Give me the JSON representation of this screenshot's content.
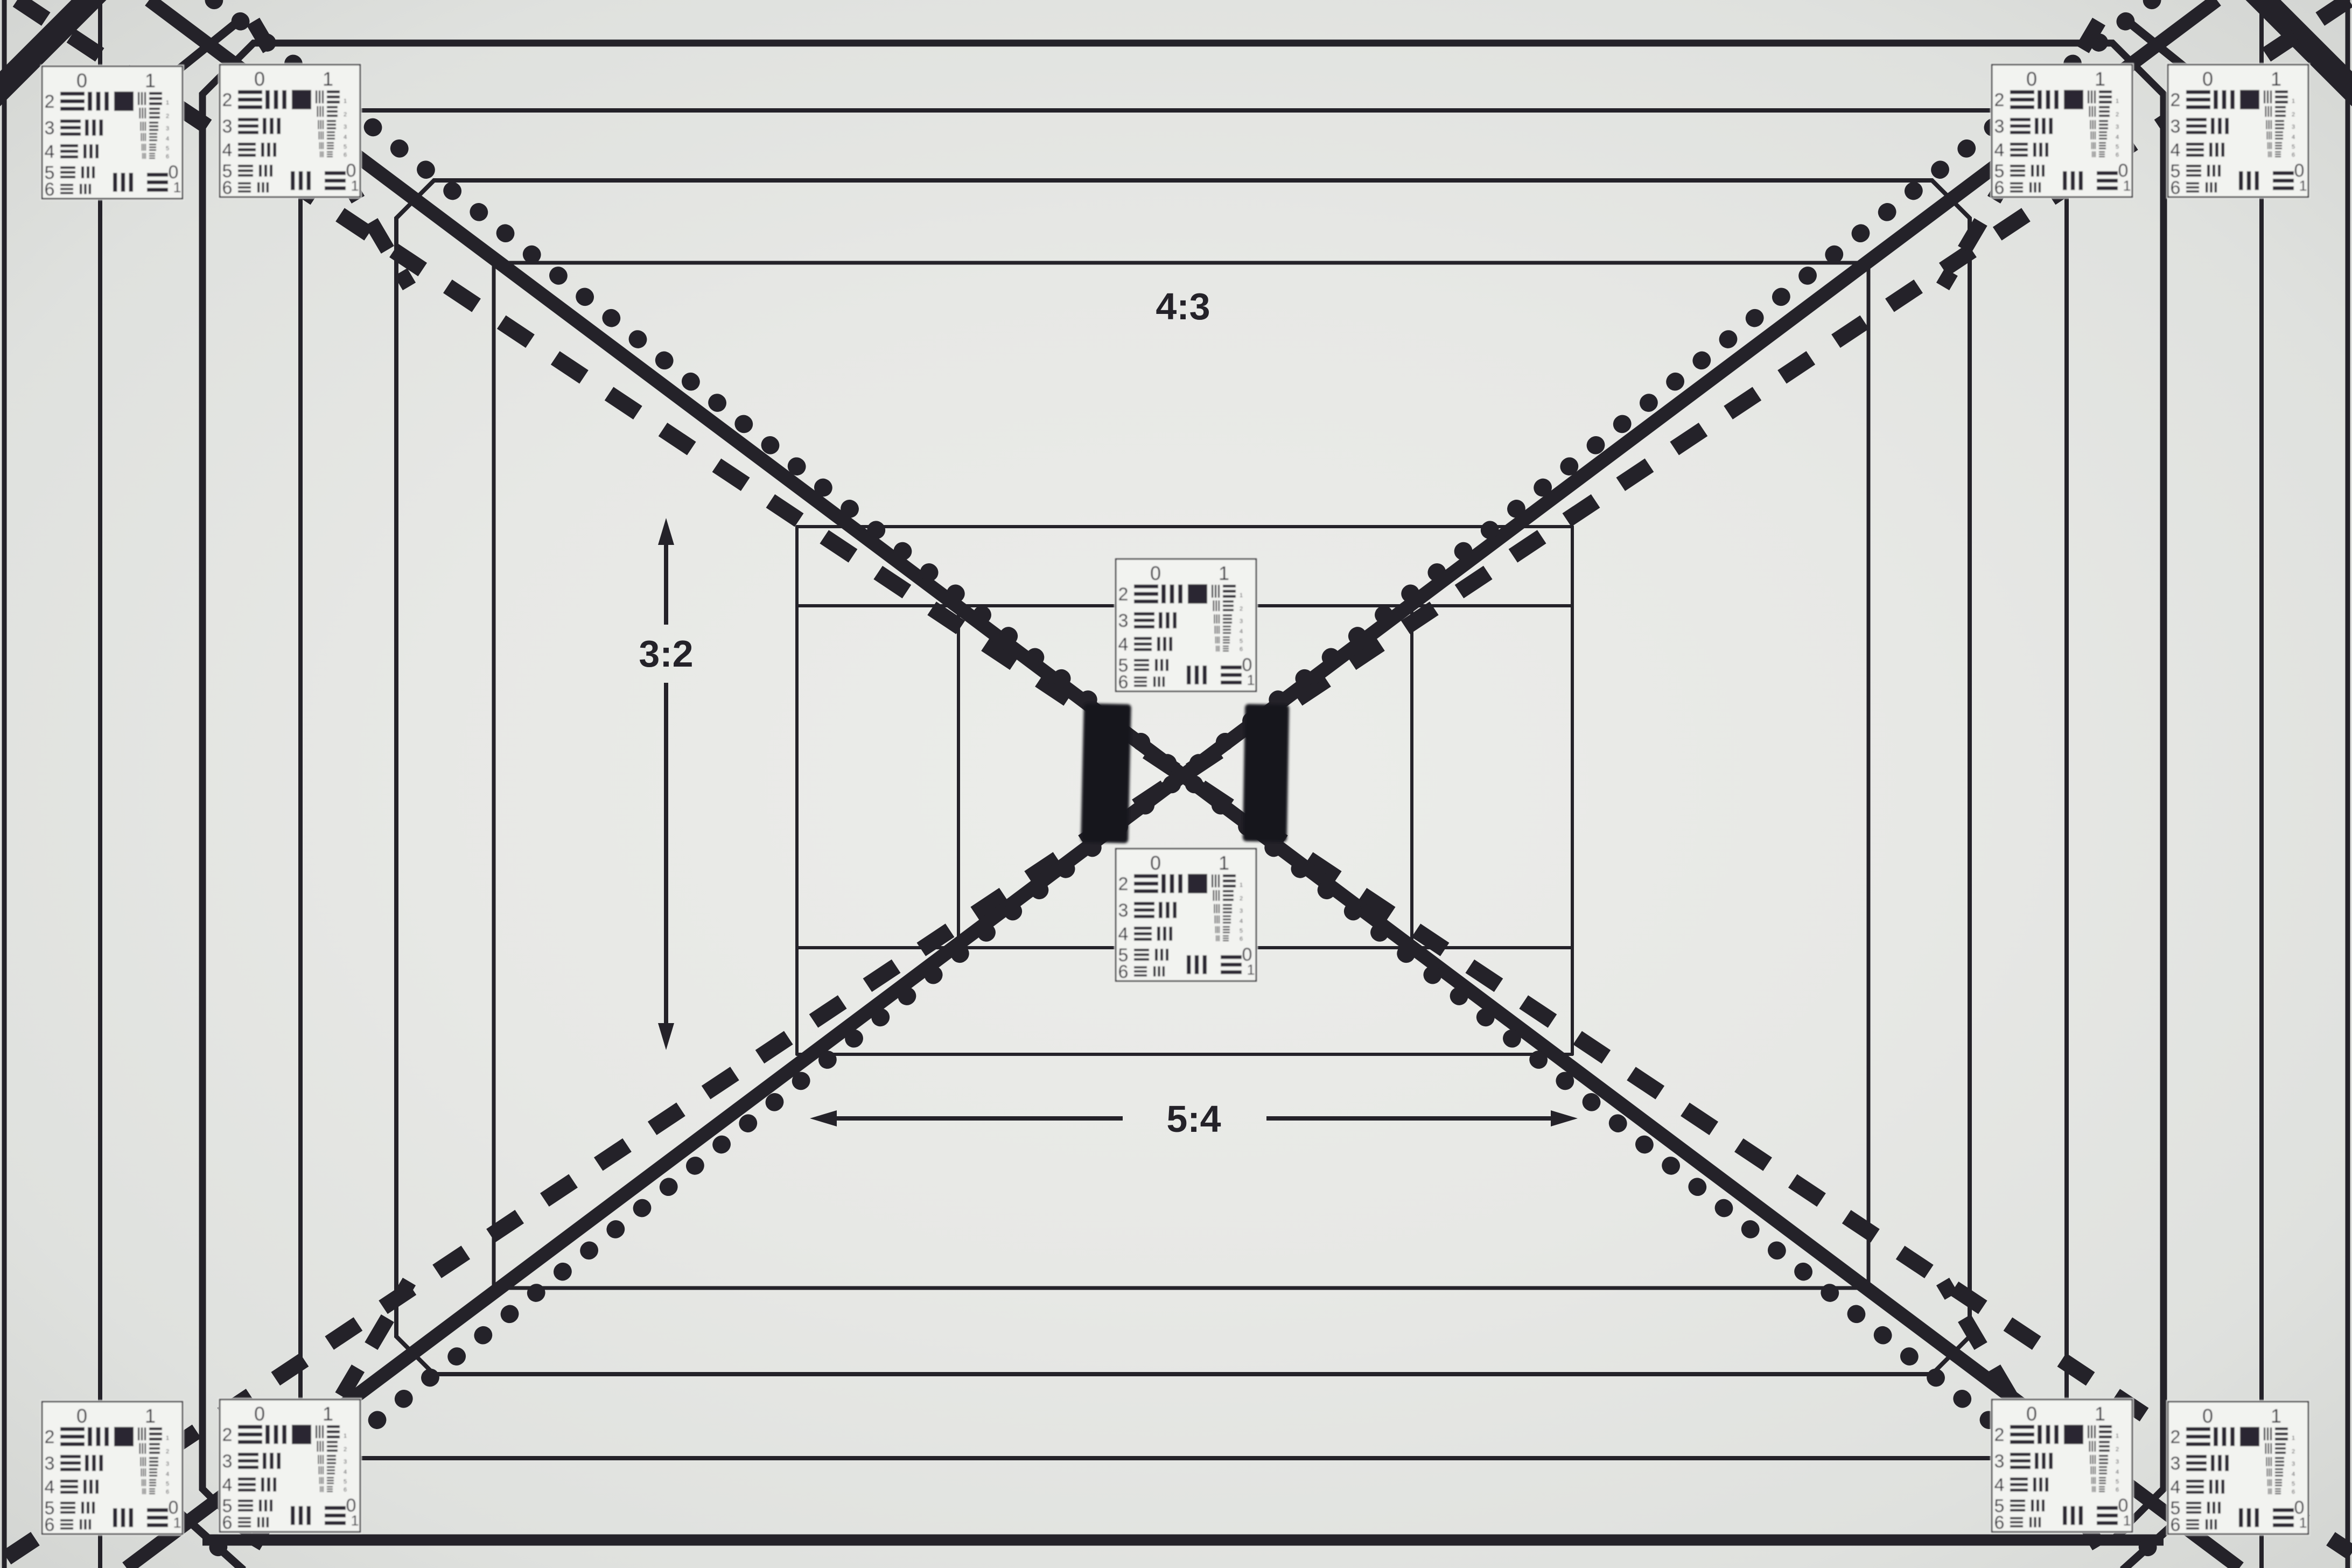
{
  "chart": {
    "description": "Photograph of a camera lens resolution test chart with nested aspect-ratio frames, diagonal convergence lines and USAF 1951 resolution targets",
    "colors": {
      "background_center": "#ecedea",
      "background_mid": "#e4e6e3",
      "background_edge": "#d2d4d1",
      "ink": "#242229",
      "target_paper": "#f2f3f0",
      "target_ink": "#2b2830",
      "velcro_pad": "#15181a"
    },
    "labels": {
      "aspect_4_3": "4:3",
      "aspect_3_2": "3:2",
      "aspect_5_4": "5:4"
    },
    "usaf_target": {
      "top_numbers": [
        "0",
        "1"
      ],
      "row_numbers": [
        "2",
        "3",
        "4",
        "5",
        "6"
      ],
      "element_numbers": [
        "1",
        "2",
        "3",
        "4",
        "5",
        "6"
      ],
      "bottom_numbers": [
        "0",
        "1"
      ]
    }
  }
}
